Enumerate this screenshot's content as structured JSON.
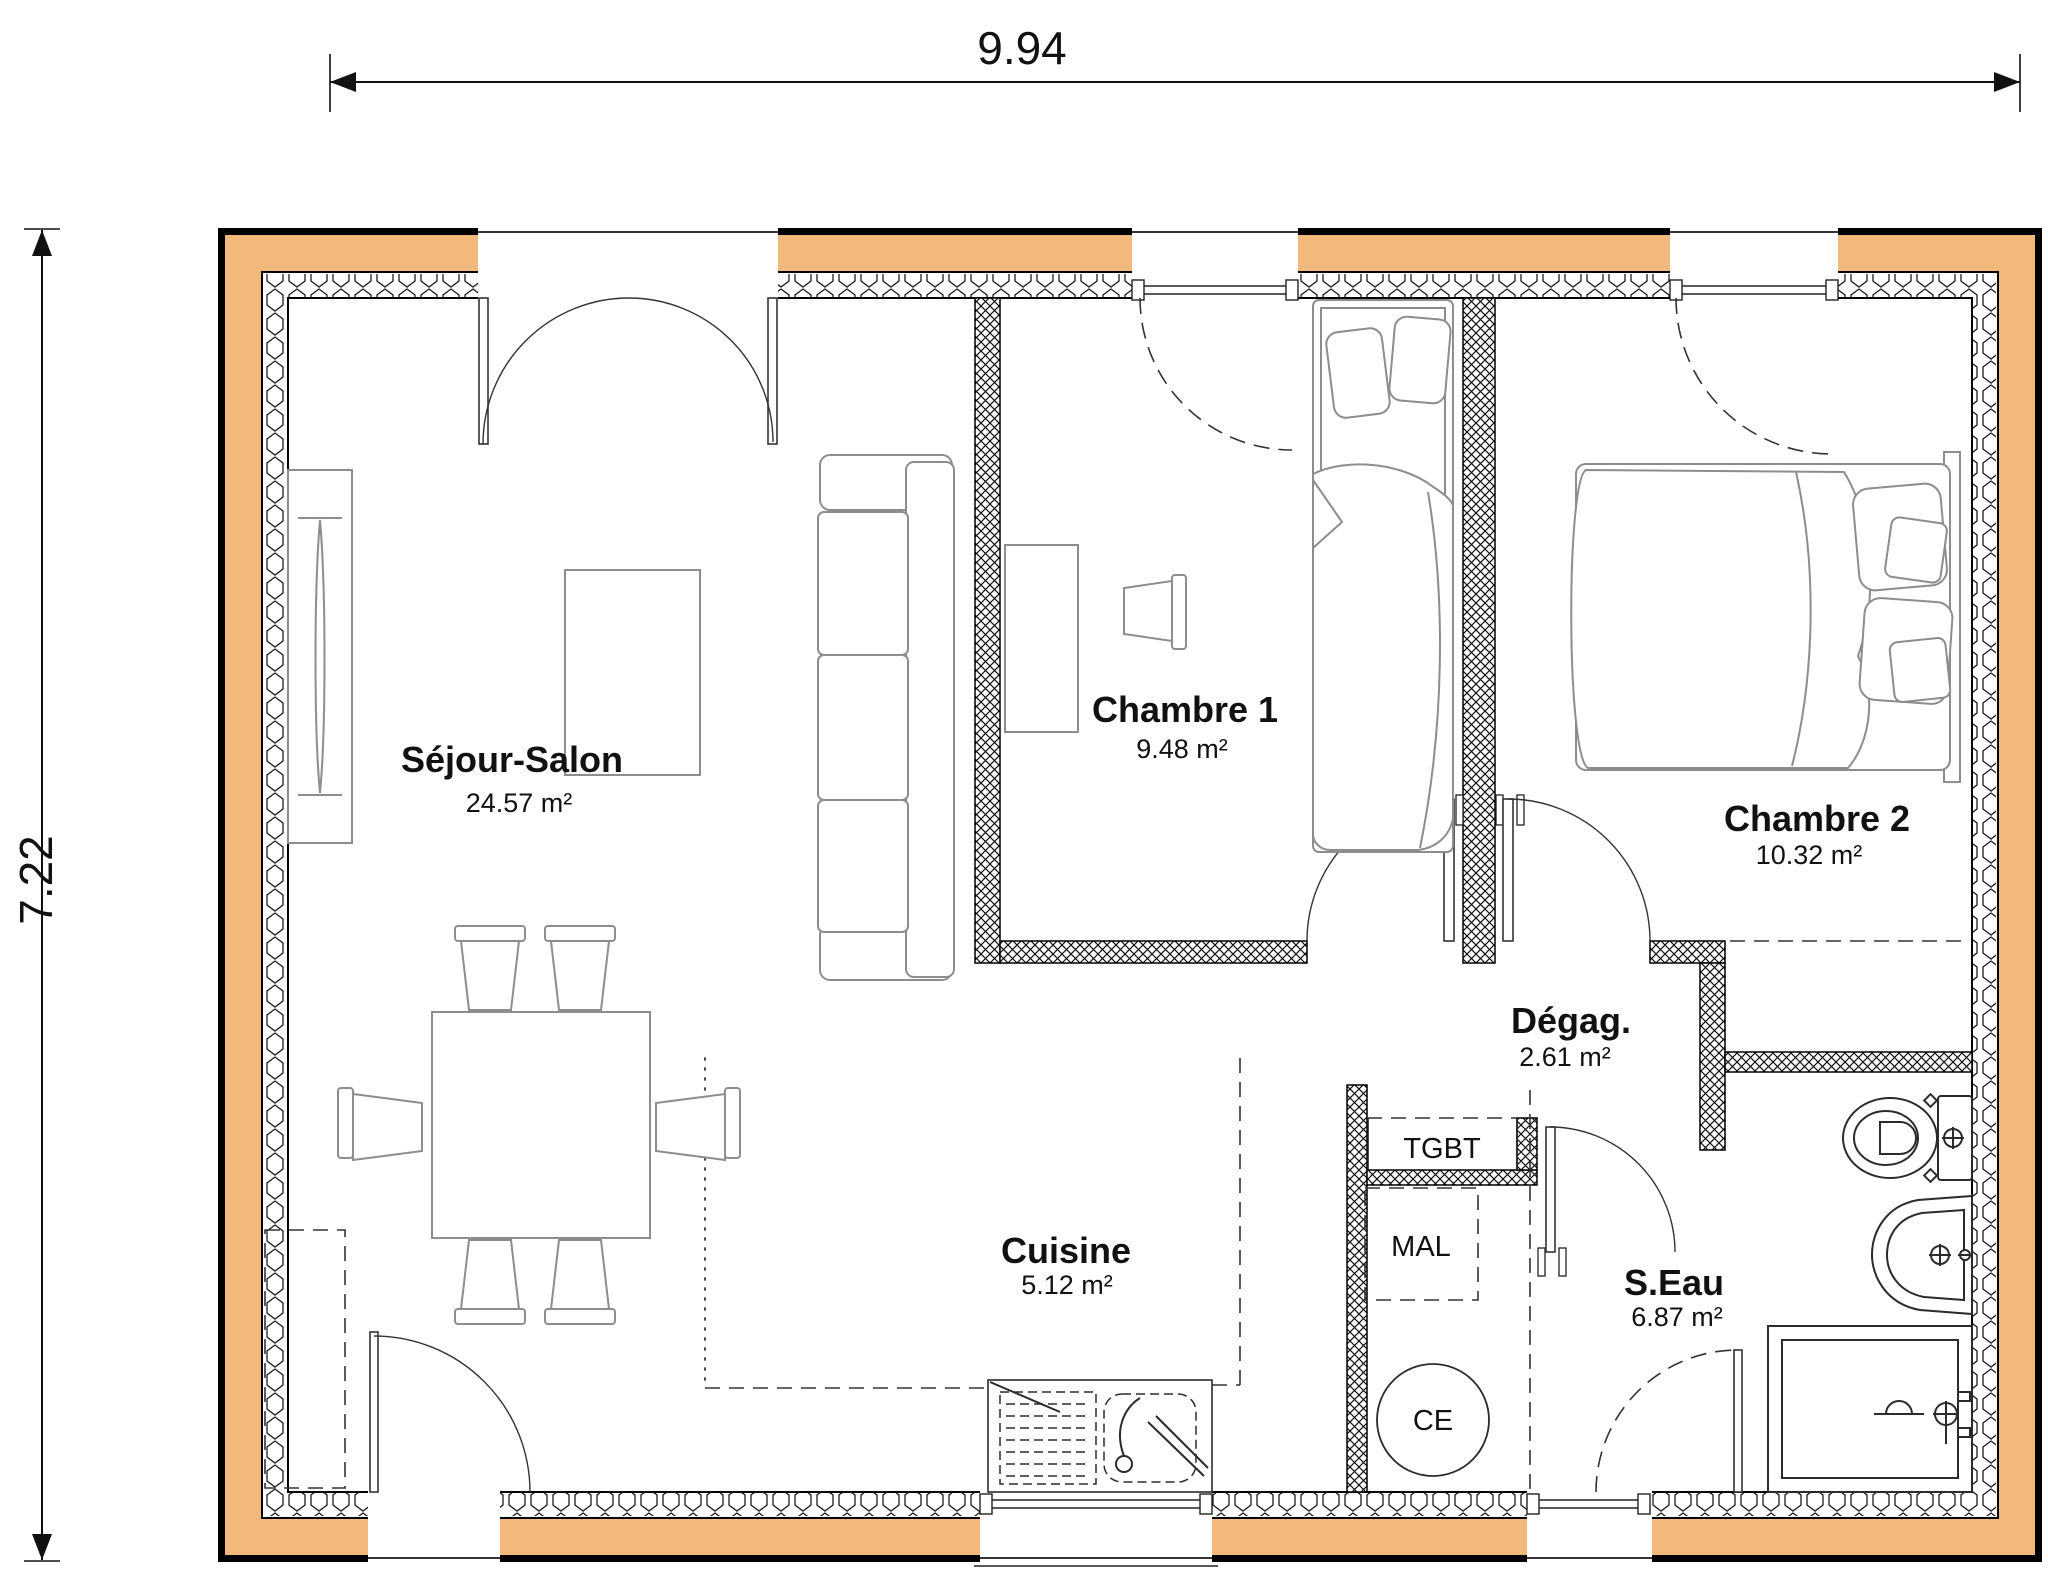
{
  "plan": {
    "dim_top": "9.94",
    "dim_left": "7.22",
    "rooms": [
      {
        "name": "Séjour-Salon",
        "area": "24.57 m²"
      },
      {
        "name": "Chambre 1",
        "area": "9.48 m²"
      },
      {
        "name": "Chambre 2",
        "area": "10.32 m²"
      },
      {
        "name": "Dégag.",
        "area": "2.61 m²"
      },
      {
        "name": "Cuisine",
        "area": "5.12 m²"
      },
      {
        "name": "S.Eau",
        "area": "6.87 m²"
      }
    ],
    "equipment": {
      "tgbt": "TGBT",
      "mal": "MAL",
      "ce": "CE"
    },
    "colors": {
      "exterior_wall_fill": "#f1ba7c",
      "wall_line": "#000000",
      "furniture_line": "#8d8d8d"
    }
  }
}
